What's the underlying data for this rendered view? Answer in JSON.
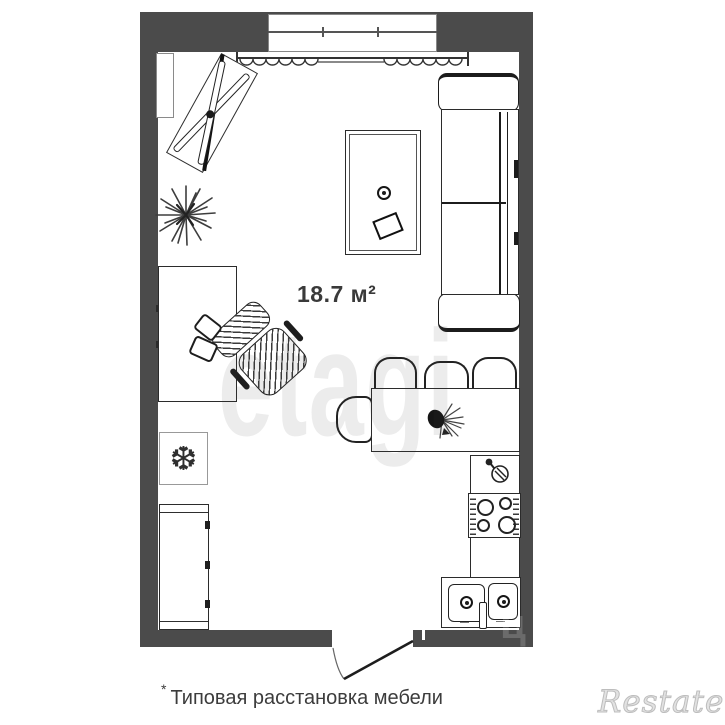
{
  "plan": {
    "area_label": "18.7 м²",
    "caption_star": "*",
    "caption_text": "Типовая расстановка мебели"
  },
  "watermarks": {
    "etagi": "etagi",
    "cian": "циан",
    "restate": "Restate"
  },
  "icons": {
    "freezer_glyph": "❆"
  },
  "colors": {
    "wall": "#4b4b4b",
    "line": "#2b2b2b",
    "soft": "#6a6a6a"
  }
}
